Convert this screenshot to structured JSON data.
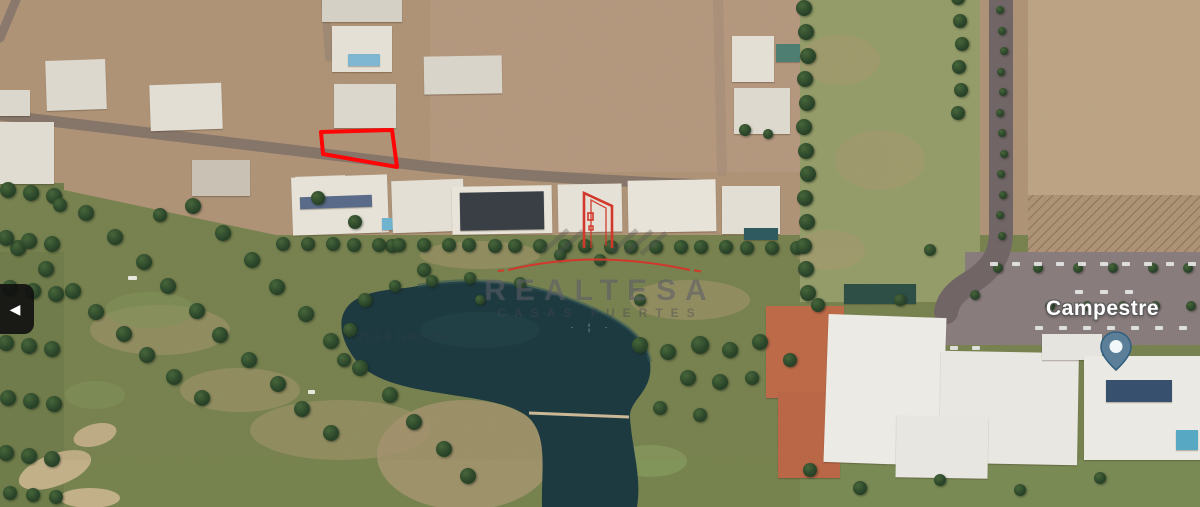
{
  "map": {
    "street_label": "Campestre",
    "attribution": "2024 Google",
    "watermark": {
      "brand": "REALTESA",
      "tagline": "CASAS FUERTES"
    },
    "plot_outline_color": "#ff0505",
    "pin_fill": "#5b7f99",
    "pin_dot": "#f2f8fa"
  },
  "carousel": {
    "prev_icon": "◀"
  }
}
